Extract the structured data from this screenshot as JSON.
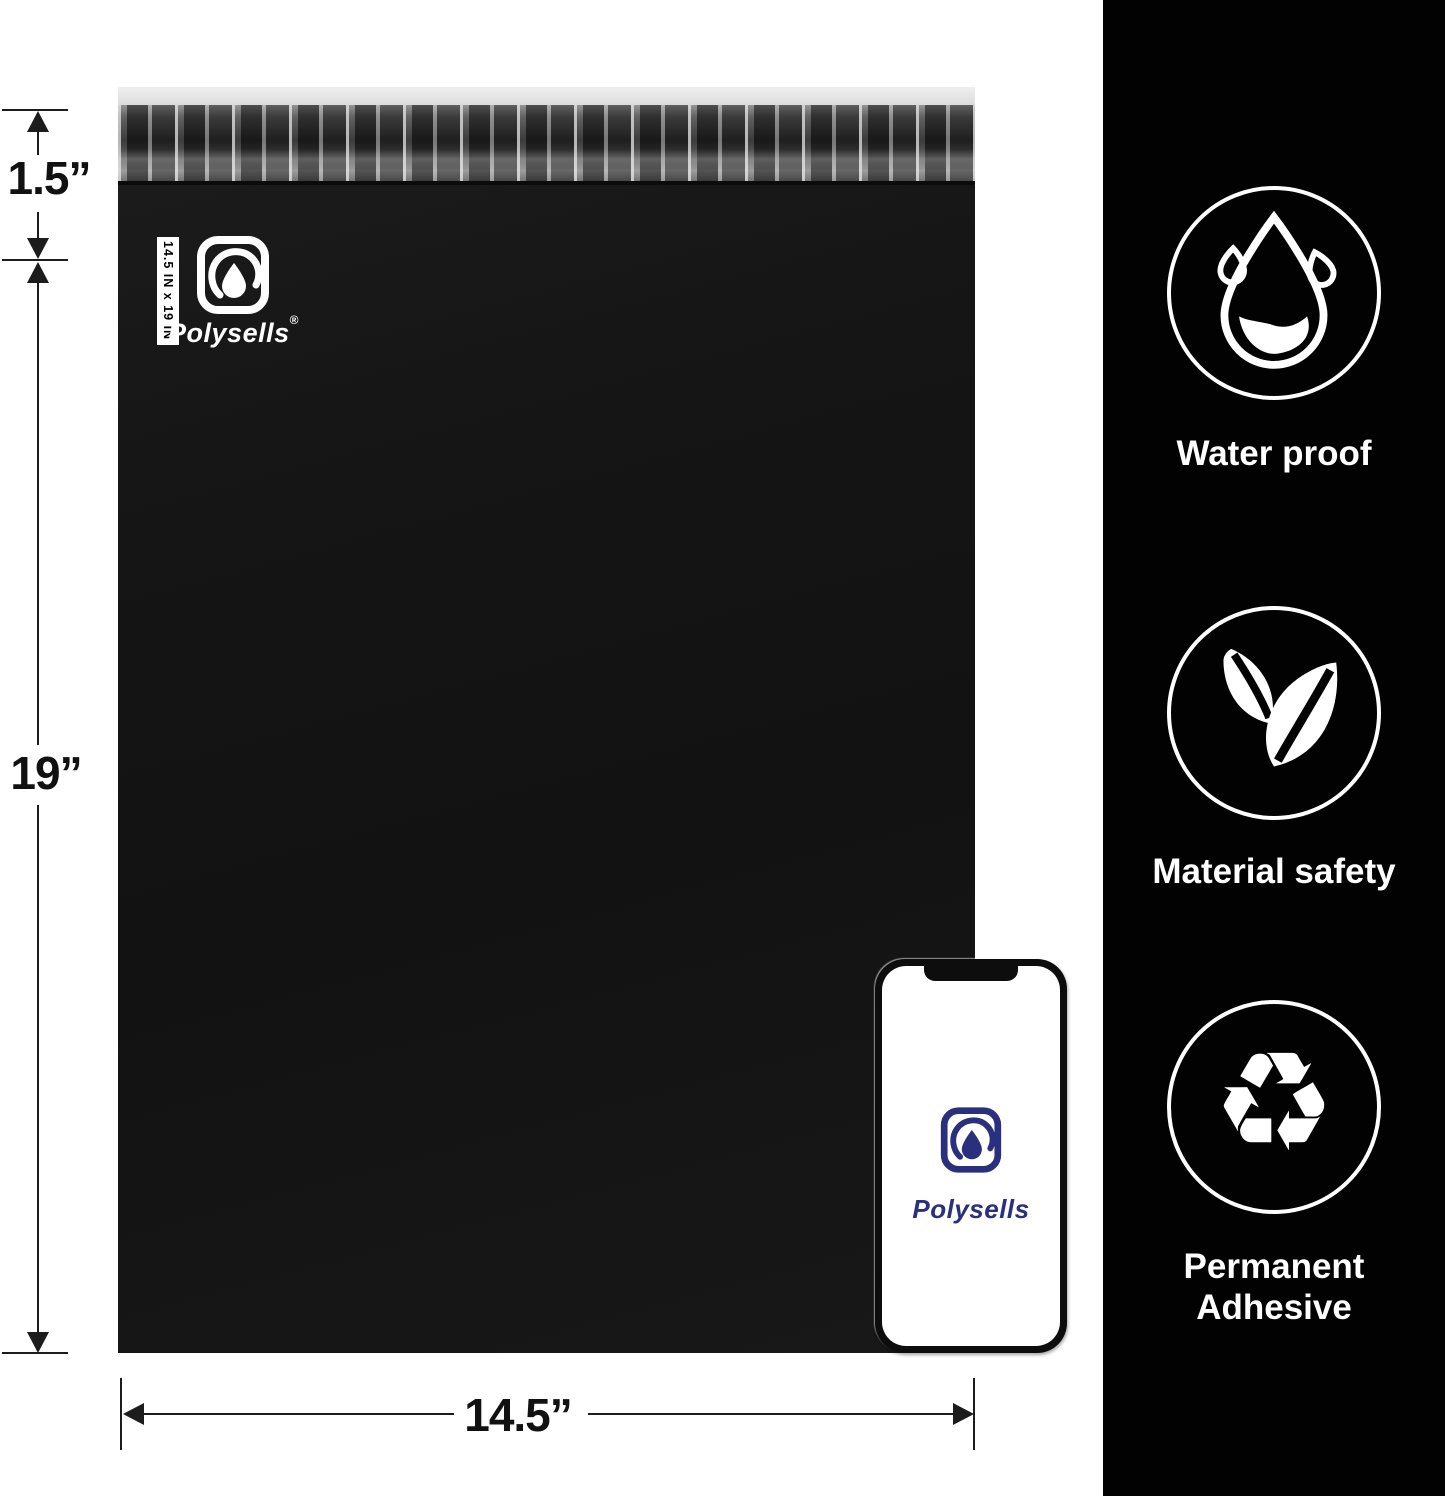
{
  "dimensions": {
    "flap_height": "1.5”",
    "bag_height": "19”",
    "bag_width": "14.5”"
  },
  "bag": {
    "size_tag": "14.5 IN x 19 IN",
    "brand": "Polysells",
    "registered": "®",
    "color": "#151515",
    "top_strip_color": "#e3e3e3"
  },
  "phone": {
    "brand": "Polysells",
    "logo_color": "#2a2f7e"
  },
  "sidebar": {
    "background": "#020202",
    "features": [
      {
        "icon": "water-drop-icon",
        "label": "Water proof"
      },
      {
        "icon": "leaves-icon",
        "label": "Material safety"
      },
      {
        "icon": "recycle-icon",
        "label": "Permanent Adhesive"
      }
    ]
  },
  "icons": {
    "recycle_glyph": "♻"
  }
}
